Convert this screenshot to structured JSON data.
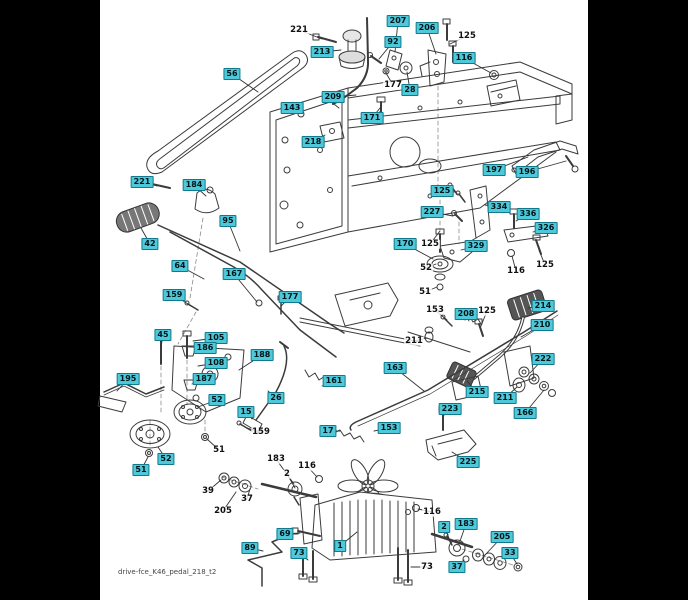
{
  "page": {
    "background": "#000000",
    "paper": "#ffffff",
    "paper_left": 100,
    "paper_width": 488
  },
  "footer": {
    "filename": "drive-fce_K46_pedal_218_t2"
  },
  "style": {
    "callout_bg": "#4fc8da",
    "callout_border": "#0d7b8d",
    "callout_text": "#001518",
    "plain_text": "#111111",
    "leader": "#333333"
  },
  "callouts": [
    {
      "label": "221",
      "x": 299,
      "y": 30,
      "boxed": false,
      "tx": 322,
      "ty": 39
    },
    {
      "label": "213",
      "x": 322,
      "y": 52,
      "boxed": true,
      "tx": 341,
      "ty": 50
    },
    {
      "label": "207",
      "x": 398,
      "y": 21,
      "boxed": true,
      "tx": 395,
      "ty": 52
    },
    {
      "label": "92",
      "x": 393,
      "y": 42,
      "boxed": true,
      "tx": 379,
      "ty": 59
    },
    {
      "label": "206",
      "x": 427,
      "y": 28,
      "boxed": true,
      "tx": 436,
      "ty": 54
    },
    {
      "label": "125",
      "x": 467,
      "y": 36,
      "boxed": false,
      "tx": 450,
      "ty": 44
    },
    {
      "label": "116",
      "x": 464,
      "y": 58,
      "boxed": true,
      "tx": 491,
      "ty": 73
    },
    {
      "label": "56",
      "x": 232,
      "y": 74,
      "boxed": true,
      "tx": 258,
      "ty": 92
    },
    {
      "label": "177",
      "x": 393,
      "y": 85,
      "boxed": false,
      "tx": 386,
      "ty": 73
    },
    {
      "label": "28",
      "x": 410,
      "y": 90,
      "boxed": true,
      "tx": 407,
      "ty": 72
    },
    {
      "label": "209",
      "x": 333,
      "y": 97,
      "boxed": true,
      "tx": 356,
      "ty": 95
    },
    {
      "label": "143",
      "x": 292,
      "y": 108,
      "boxed": true,
      "tx": 299,
      "ty": 113
    },
    {
      "label": "171",
      "x": 372,
      "y": 118,
      "boxed": true,
      "tx": 380,
      "ty": 108
    },
    {
      "label": "218",
      "x": 313,
      "y": 142,
      "boxed": true,
      "tx": 325,
      "ty": 135
    },
    {
      "label": "197",
      "x": 494,
      "y": 170,
      "boxed": true,
      "tx": 528,
      "ty": 157
    },
    {
      "label": "196",
      "x": 527,
      "y": 172,
      "boxed": true,
      "tx": 566,
      "ty": 161
    },
    {
      "label": "221",
      "x": 142,
      "y": 182,
      "boxed": true,
      "tx": 157,
      "ty": 186
    },
    {
      "label": "184",
      "x": 194,
      "y": 185,
      "boxed": true,
      "tx": 206,
      "ty": 196
    },
    {
      "label": "125",
      "x": 442,
      "y": 191,
      "boxed": true,
      "tx": 455,
      "ty": 192
    },
    {
      "label": "334",
      "x": 499,
      "y": 207,
      "boxed": true,
      "tx": 485,
      "ty": 205
    },
    {
      "label": "227",
      "x": 432,
      "y": 212,
      "boxed": true,
      "tx": 453,
      "ty": 216
    },
    {
      "label": "336",
      "x": 528,
      "y": 214,
      "boxed": true,
      "tx": 516,
      "ty": 221
    },
    {
      "label": "95",
      "x": 228,
      "y": 221,
      "boxed": true,
      "tx": 240,
      "ty": 251
    },
    {
      "label": "326",
      "x": 546,
      "y": 228,
      "boxed": true,
      "tx": 533,
      "ty": 232
    },
    {
      "label": "42",
      "x": 150,
      "y": 244,
      "boxed": true,
      "tx": 141,
      "ty": 228
    },
    {
      "label": "170",
      "x": 405,
      "y": 244,
      "boxed": true,
      "tx": 433,
      "ty": 259
    },
    {
      "label": "125",
      "x": 430,
      "y": 244,
      "boxed": false,
      "tx": 440,
      "ty": 231
    },
    {
      "label": "329",
      "x": 476,
      "y": 246,
      "boxed": true,
      "tx": 461,
      "ty": 250
    },
    {
      "label": "125",
      "x": 545,
      "y": 265,
      "boxed": false,
      "tx": 539,
      "ty": 250
    },
    {
      "label": "64",
      "x": 180,
      "y": 266,
      "boxed": true,
      "tx": 204,
      "ty": 279
    },
    {
      "label": "52",
      "x": 426,
      "y": 268,
      "boxed": false,
      "tx": 436,
      "ty": 264
    },
    {
      "label": "116",
      "x": 516,
      "y": 271,
      "boxed": false,
      "tx": 512,
      "ty": 256
    },
    {
      "label": "167",
      "x": 234,
      "y": 274,
      "boxed": true,
      "tx": 257,
      "ty": 302
    },
    {
      "label": "51",
      "x": 425,
      "y": 292,
      "boxed": false,
      "tx": 437,
      "ty": 287
    },
    {
      "label": "159",
      "x": 174,
      "y": 295,
      "boxed": true,
      "tx": 191,
      "ty": 306
    },
    {
      "label": "177",
      "x": 290,
      "y": 297,
      "boxed": true,
      "tx": 281,
      "ty": 306
    },
    {
      "label": "214",
      "x": 543,
      "y": 306,
      "boxed": true,
      "tx": 528,
      "ty": 308
    },
    {
      "label": "153",
      "x": 435,
      "y": 310,
      "boxed": false,
      "tx": 447,
      "ty": 320
    },
    {
      "label": "125",
      "x": 487,
      "y": 311,
      "boxed": false,
      "tx": 481,
      "ty": 326
    },
    {
      "label": "208",
      "x": 466,
      "y": 314,
      "boxed": true,
      "tx": 469,
      "ty": 321
    },
    {
      "label": "210",
      "x": 542,
      "y": 325,
      "boxed": true,
      "tx": 521,
      "ty": 337
    },
    {
      "label": "45",
      "x": 163,
      "y": 335,
      "boxed": true,
      "tx": 161,
      "ty": 347
    },
    {
      "label": "105",
      "x": 216,
      "y": 338,
      "boxed": true,
      "tx": 193,
      "ty": 341
    },
    {
      "label": "211",
      "x": 414,
      "y": 341,
      "boxed": false,
      "tx": 427,
      "ty": 338
    },
    {
      "label": "186",
      "x": 205,
      "y": 348,
      "boxed": true,
      "tx": 194,
      "ty": 352
    },
    {
      "label": "188",
      "x": 262,
      "y": 355,
      "boxed": true,
      "tx": 239,
      "ty": 370
    },
    {
      "label": "222",
      "x": 543,
      "y": 359,
      "boxed": true,
      "tx": 530,
      "ty": 373
    },
    {
      "label": "108",
      "x": 216,
      "y": 363,
      "boxed": true,
      "tx": 198,
      "ty": 366
    },
    {
      "label": "163",
      "x": 395,
      "y": 368,
      "boxed": true,
      "tx": 424,
      "ty": 391
    },
    {
      "label": "187",
      "x": 204,
      "y": 379,
      "boxed": true,
      "tx": 192,
      "ty": 384
    },
    {
      "label": "195",
      "x": 128,
      "y": 379,
      "boxed": true,
      "tx": 117,
      "ty": 391
    },
    {
      "label": "161",
      "x": 334,
      "y": 381,
      "boxed": true,
      "tx": 322,
      "ty": 386
    },
    {
      "label": "215",
      "x": 477,
      "y": 392,
      "boxed": true,
      "tx": 467,
      "ty": 381
    },
    {
      "label": "26",
      "x": 276,
      "y": 398,
      "boxed": true,
      "tx": 268,
      "ty": 391
    },
    {
      "label": "211",
      "x": 505,
      "y": 398,
      "boxed": true,
      "tx": 517,
      "ty": 387
    },
    {
      "label": "52",
      "x": 217,
      "y": 400,
      "boxed": true,
      "tx": 198,
      "ty": 407
    },
    {
      "label": "223",
      "x": 450,
      "y": 409,
      "boxed": true,
      "tx": 443,
      "ty": 416
    },
    {
      "label": "15",
      "x": 246,
      "y": 412,
      "boxed": true,
      "tx": 252,
      "ty": 419
    },
    {
      "label": "166",
      "x": 525,
      "y": 413,
      "boxed": true,
      "tx": 544,
      "ty": 390
    },
    {
      "label": "153",
      "x": 389,
      "y": 428,
      "boxed": true,
      "tx": 374,
      "ty": 431
    },
    {
      "label": "17",
      "x": 328,
      "y": 431,
      "boxed": true,
      "tx": 340,
      "ty": 431
    },
    {
      "label": "159",
      "x": 261,
      "y": 432,
      "boxed": false,
      "tx": 247,
      "ty": 428
    },
    {
      "label": "51",
      "x": 219,
      "y": 450,
      "boxed": false,
      "tx": 207,
      "ty": 439
    },
    {
      "label": "52",
      "x": 166,
      "y": 459,
      "boxed": true,
      "tx": 158,
      "ty": 447
    },
    {
      "label": "183",
      "x": 276,
      "y": 459,
      "boxed": false,
      "tx": 294,
      "ty": 484
    },
    {
      "label": "225",
      "x": 468,
      "y": 462,
      "boxed": true,
      "tx": 452,
      "ty": 452
    },
    {
      "label": "116",
      "x": 307,
      "y": 466,
      "boxed": false,
      "tx": 317,
      "ty": 477
    },
    {
      "label": "51",
      "x": 141,
      "y": 470,
      "boxed": true,
      "tx": 148,
      "ty": 457
    },
    {
      "label": "2",
      "x": 287,
      "y": 474,
      "boxed": false,
      "tx": 295,
      "ty": 488
    },
    {
      "label": "39",
      "x": 208,
      "y": 491,
      "boxed": false,
      "tx": 221,
      "ty": 480
    },
    {
      "label": "37",
      "x": 247,
      "y": 499,
      "boxed": false,
      "tx": 250,
      "ty": 489
    },
    {
      "label": "205",
      "x": 223,
      "y": 511,
      "boxed": false,
      "tx": 236,
      "ty": 492
    },
    {
      "label": "116",
      "x": 432,
      "y": 512,
      "boxed": false,
      "tx": 418,
      "ty": 509
    },
    {
      "label": "183",
      "x": 466,
      "y": 524,
      "boxed": true,
      "tx": 459,
      "ty": 544
    },
    {
      "label": "2",
      "x": 444,
      "y": 527,
      "boxed": true,
      "tx": 449,
      "ty": 538
    },
    {
      "label": "69",
      "x": 285,
      "y": 534,
      "boxed": true,
      "tx": 300,
      "ty": 533
    },
    {
      "label": "205",
      "x": 502,
      "y": 537,
      "boxed": true,
      "tx": 485,
      "ty": 555
    },
    {
      "label": "1",
      "x": 340,
      "y": 546,
      "boxed": true,
      "tx": 357,
      "ty": 532
    },
    {
      "label": "89",
      "x": 250,
      "y": 548,
      "boxed": true,
      "tx": 263,
      "ty": 551
    },
    {
      "label": "33",
      "x": 510,
      "y": 553,
      "boxed": true,
      "tx": 517,
      "ty": 564
    },
    {
      "label": "73",
      "x": 299,
      "y": 553,
      "boxed": true,
      "tx": 308,
      "ty": 560
    },
    {
      "label": "37",
      "x": 457,
      "y": 567,
      "boxed": true,
      "tx": 464,
      "ty": 560
    },
    {
      "label": "73",
      "x": 427,
      "y": 567,
      "boxed": false,
      "tx": 411,
      "ty": 567
    }
  ]
}
